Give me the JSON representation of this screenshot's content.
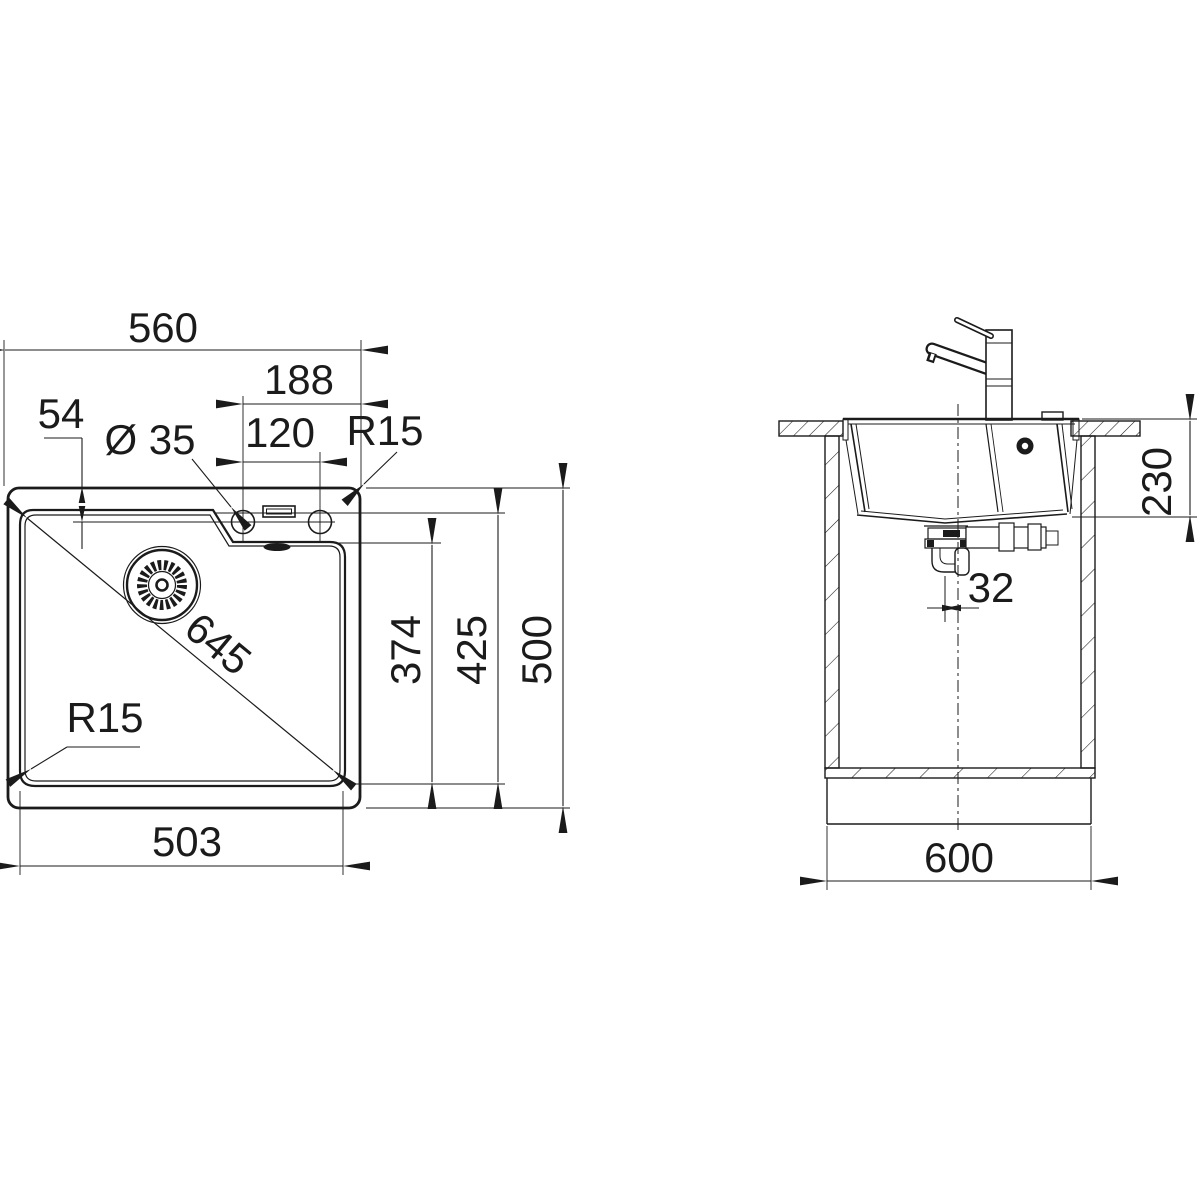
{
  "drawing": {
    "line_color": "#1b1b1b",
    "background": "#ffffff",
    "top_view": {
      "overall_width": "560",
      "tap_zone_width": "188",
      "edge_to_tap": "54",
      "tap_hole_diameter": "Ø 35",
      "tap_spacing": "120",
      "rim_corner_radius": "R15",
      "bowl_diagonal": "645",
      "bowl_corner_radius": "R15",
      "ledge_to_front": "374",
      "bowl_length": "425",
      "overall_depth": "500",
      "bowl_width": "503"
    },
    "side_view": {
      "bowl_depth": "230",
      "drain_offset": "32",
      "cabinet_width": "600"
    }
  }
}
